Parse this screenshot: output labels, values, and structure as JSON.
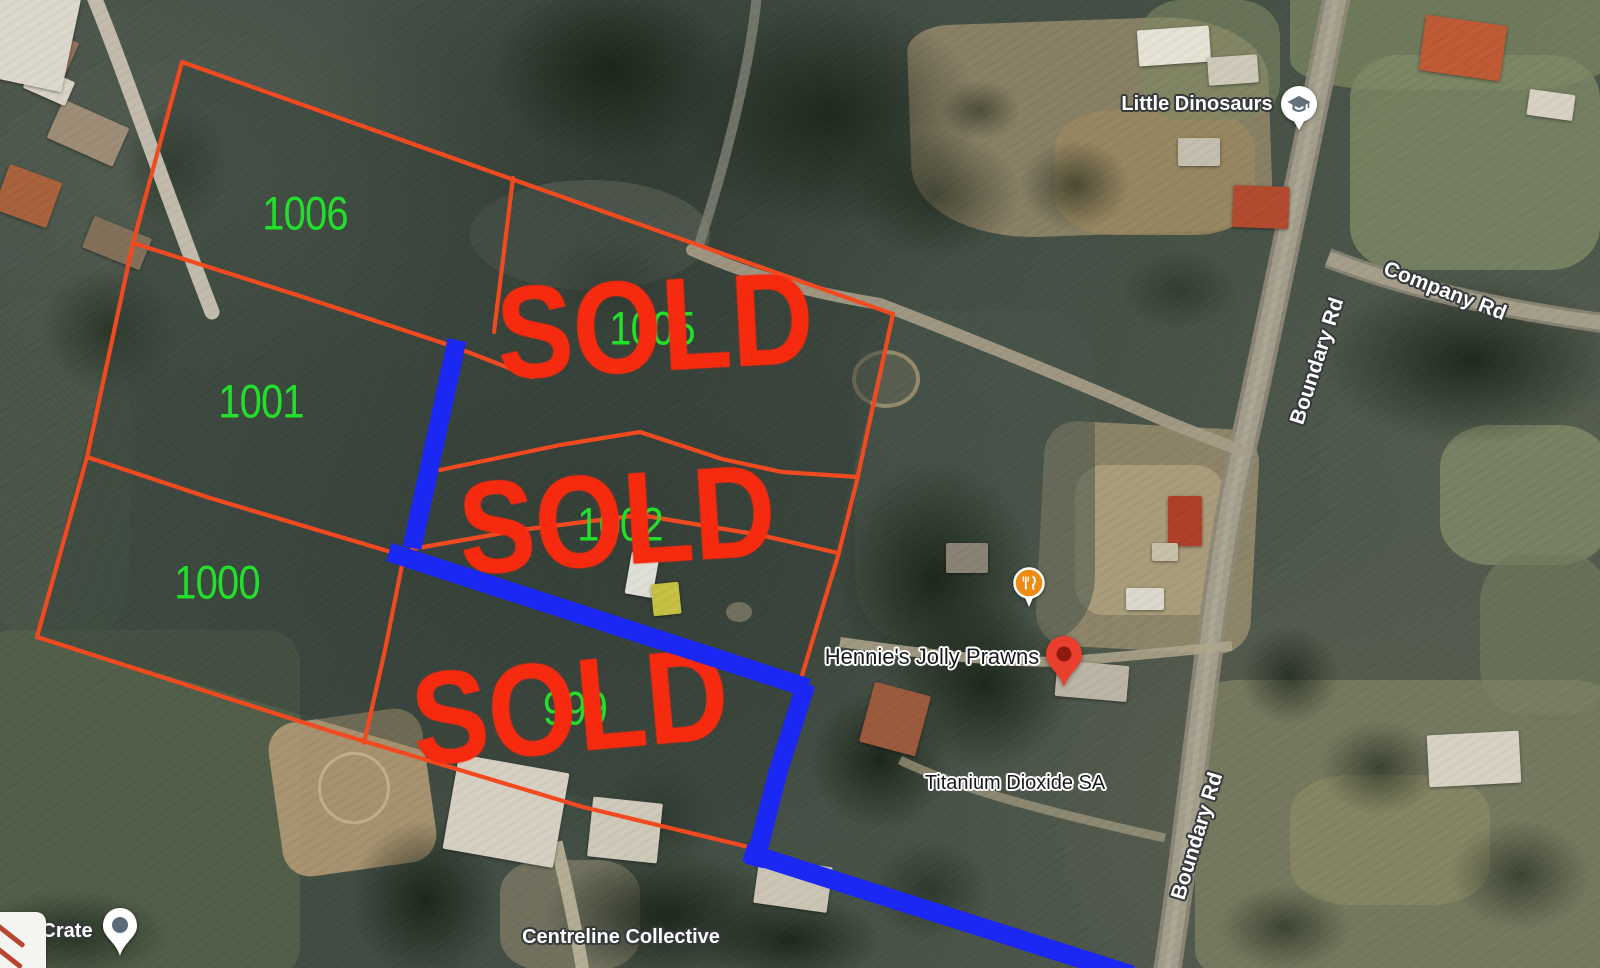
{
  "annotations": {
    "sold_label": "SOLD",
    "plot_numbers": {
      "p1006": "1006",
      "p1001": "1001",
      "p1000": "1000",
      "p1005": "1005",
      "p1002": "1002",
      "p999": "999"
    },
    "colors": {
      "plot_line": "#f24a20",
      "sold_text": "#f52a0e",
      "plot_number": "#22df2b",
      "boundary_highlight": "#1b27f2",
      "restaurant_pin": "#ef8a12",
      "place_pin": "#e8402d"
    }
  },
  "map_labels": {
    "little_dinosaurs": "Little Dinosaurs",
    "company_rd": "Company Rd",
    "boundary_rd_upper": "Boundary Rd",
    "boundary_rd_lower": "Boundary Rd",
    "hennies_jolly_prawns": "Hennie's Jolly Prawns",
    "titanium_dioxide": "Titanium Dioxide SA",
    "centreline_collective": "Centreline Collective",
    "crate_partial": "nd Crate"
  },
  "icons": {
    "education_pin": "graduation-cap",
    "restaurant_pin": "fork-knife",
    "place_pin": "red-marker",
    "crate_pin": "dot-marker"
  }
}
